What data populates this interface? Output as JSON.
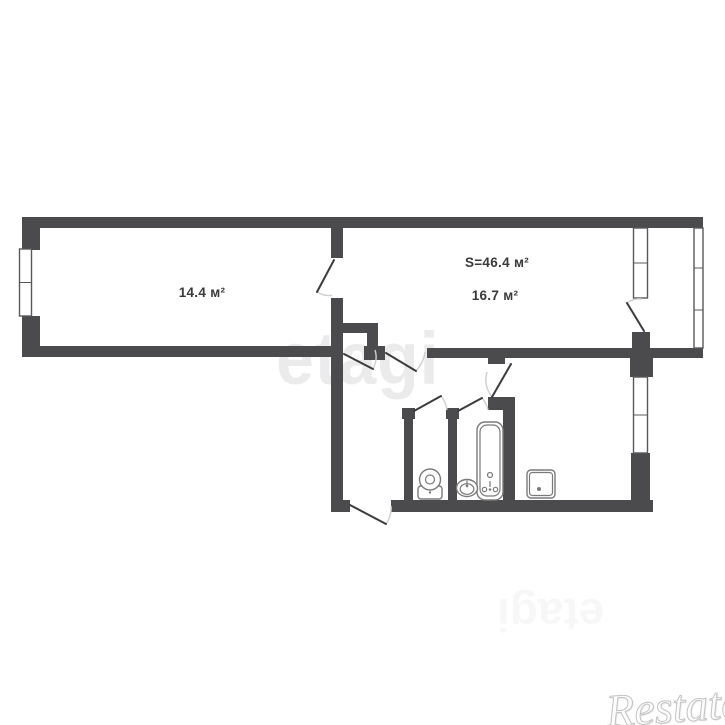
{
  "title": "Apartment floor plan",
  "rooms": [
    {
      "name": "room-1",
      "area_label": "14.4 м²"
    },
    {
      "name": "room-2",
      "area_label": "16.7 м²"
    },
    {
      "name": "apartment-total",
      "area_label": "S=46.4 м²"
    }
  ],
  "fixtures": [
    "toilet",
    "sink",
    "bathtub",
    "stove"
  ],
  "watermarks": {
    "center": "etagi",
    "faint": "etagi",
    "corner": "Restate"
  },
  "colors": {
    "wall": "#4b4b4d",
    "door_line": "#3c3c3e",
    "arc": "#cfcfcf",
    "fixture": "#7a7a7a",
    "label": "#3a3a3a",
    "window_line": "#59595b",
    "watermark_center": "rgba(0,0,0,0.078)",
    "watermark_faint": "rgba(0,0,0,0.03)",
    "watermark_corner": "#c3c3c3"
  }
}
